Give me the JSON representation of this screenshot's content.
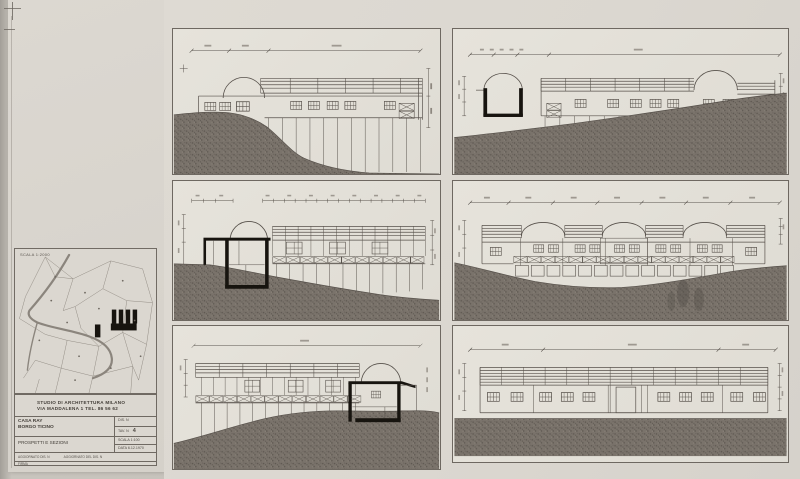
{
  "titleblock": {
    "studio_line1": "STUDIO DI ARCHITETTURA   MILANO",
    "studio_line2": "VIA MADDALENA 1   TEL.   86 56 62",
    "project_name": "CASA RAY",
    "project_location": "BORGO TICINO",
    "drawing_title": "PROSPETTI E SEZIONI",
    "dis_label": "DIS. N",
    "tav_label": "TAV. N",
    "tav_number": "4",
    "scala_value": "SCALA  1:100",
    "data_value": "DATA  6.12.1970",
    "agg_left": "AGGIORNATO DIS. N",
    "agg_right": "AGGIORNATO DEL DIS. N",
    "firma": "FIRMA"
  },
  "site_plan": {
    "scale_label": "SCALA 1:2000"
  },
  "accent_colors": {
    "paper": "#dcd8d1",
    "line": "#57514b",
    "poche_black": "#17140f",
    "ground": "#7a736b"
  }
}
